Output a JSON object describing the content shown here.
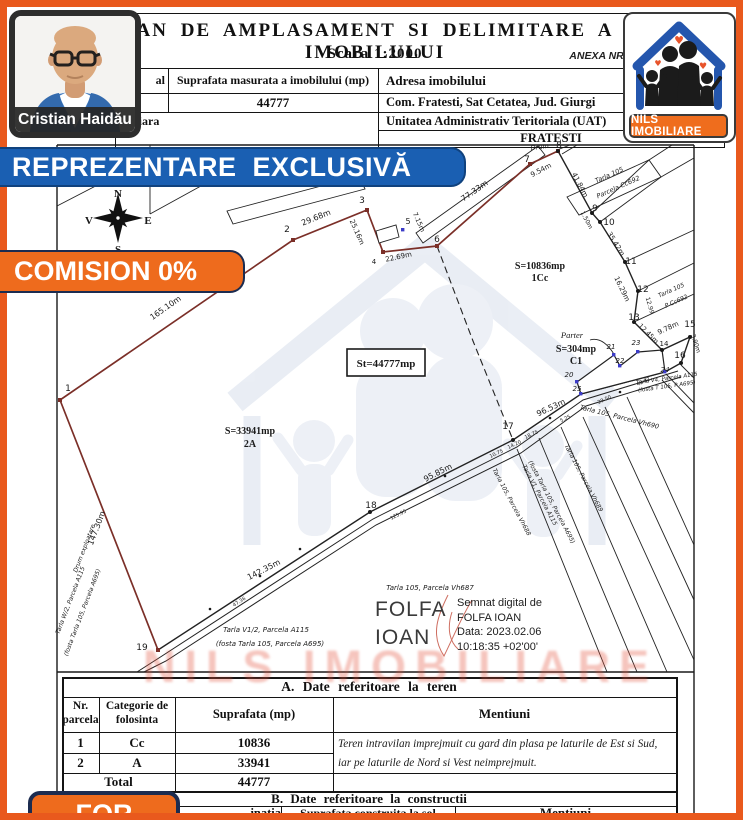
{
  "header": {
    "title_visible": "AN DE AMPLASAMENT SI DELIMITARE A IMOBILULUI",
    "scale": "Scara 1:2000",
    "annex": "ANEXA NR. 1.35",
    "col1_row1_fragment": "al",
    "surface_label": "Suprafata masurata a imobilului (mp)",
    "address_label": "Adresa imobilului",
    "surface_value": "44777",
    "address_value": "Com. Fratesti, Sat Cetatea, Jud. Giurgi",
    "col1_row3_fragment": "unciara",
    "uat_label": "Unitatea Administrativ Teritoriala (UAT)",
    "uat_value": "FRATESTI"
  },
  "agent": {
    "name": "Cristian Haidău"
  },
  "logo": {
    "label": "NILS IMOBILIARE"
  },
  "banners": {
    "exclusive": "REPREZENTARE EXCLUSIVĂ",
    "commission": "COMISION 0%",
    "corner": "FOR"
  },
  "watermark": {
    "text": "NILS IMOBILIARE"
  },
  "signature": {
    "name_line1": "FOLFA",
    "name_line2": "IOAN",
    "lines": [
      "Semnat digital de",
      "FOLFA IOAN",
      "Data: 2023.02.06",
      "10:18:35 +02'00'"
    ]
  },
  "table_a": {
    "section_title": "A. Date referitoare la teren",
    "h_nr_1": "Nr.",
    "h_nr_2": "parcela",
    "h_cat_1": "Categorie de",
    "h_cat_2": "folosinta",
    "h_sup": "Suprafata (mp)",
    "h_men": "Mentiuni",
    "rows": [
      {
        "nr": "1",
        "cat": "Cc",
        "area": "10836"
      },
      {
        "nr": "2",
        "cat": "A",
        "area": "33941"
      }
    ],
    "mentiuni_line1": "Teren intravilan imprejmuit cu gard din plasa pe laturile de Est si Sud,",
    "mentiuni_line2": "iar pe laturile de Nord si Vest neimprejmuit.",
    "total_label": "Total",
    "total_value": "44777"
  },
  "table_b": {
    "section_title": "B. Date referitoare la constructii",
    "destinatia_fragment": "inatia",
    "h_sup_1": "Suprafata construita la sol",
    "h_sup_2": "(mp)",
    "h_men": "Mentiuni"
  },
  "plan": {
    "labels": [
      {
        "t": "1",
        "x": 68,
        "y": 391,
        "s": 9
      },
      {
        "t": "2",
        "x": 287,
        "y": 232,
        "s": 9
      },
      {
        "t": "3",
        "x": 362,
        "y": 203,
        "s": 9
      },
      {
        "t": "4",
        "x": 374,
        "y": 264,
        "s": 7
      },
      {
        "t": "5",
        "x": 408,
        "y": 224,
        "s": 8
      },
      {
        "t": "6",
        "x": 437,
        "y": 242,
        "s": 9
      },
      {
        "t": "7",
        "x": 527,
        "y": 162,
        "s": 9
      },
      {
        "t": "8",
        "x": 559,
        "y": 148,
        "s": 9
      },
      {
        "t": "9",
        "x": 595,
        "y": 211,
        "s": 9
      },
      {
        "t": "10",
        "x": 609,
        "y": 225,
        "s": 9
      },
      {
        "t": "11",
        "x": 631,
        "y": 264,
        "s": 9
      },
      {
        "t": "12",
        "x": 643,
        "y": 292,
        "s": 9
      },
      {
        "t": "13",
        "x": 634,
        "y": 320,
        "s": 9
      },
      {
        "t": "14",
        "x": 664,
        "y": 346,
        "s": 7
      },
      {
        "t": "15",
        "x": 690,
        "y": 327,
        "s": 9
      },
      {
        "t": "16",
        "x": 680,
        "y": 358,
        "s": 9
      },
      {
        "t": "17",
        "x": 508,
        "y": 429,
        "s": 9
      },
      {
        "t": "18",
        "x": 371,
        "y": 508,
        "s": 9
      },
      {
        "t": "19",
        "x": 142,
        "y": 650,
        "s": 9
      },
      {
        "t": "20",
        "x": 569,
        "y": 377,
        "s": 7,
        "i": 1
      },
      {
        "t": "21",
        "x": 611,
        "y": 349,
        "s": 7,
        "i": 1
      },
      {
        "t": "22",
        "x": 620,
        "y": 363,
        "s": 7,
        "i": 1
      },
      {
        "t": "23",
        "x": 636,
        "y": 345,
        "s": 7,
        "i": 1
      },
      {
        "t": "24",
        "x": 665,
        "y": 372,
        "s": 7,
        "i": 1
      },
      {
        "t": "25",
        "x": 577,
        "y": 391,
        "s": 7,
        "i": 1
      },
      {
        "t": "165.10m",
        "x": 167,
        "y": 310,
        "r": -35,
        "s": 8
      },
      {
        "t": "29.68m",
        "x": 317,
        "y": 220,
        "r": -22,
        "s": 8
      },
      {
        "t": "25.16m",
        "x": 355,
        "y": 233,
        "r": 66,
        "s": 7
      },
      {
        "t": "22.69m",
        "x": 399,
        "y": 259,
        "r": -12,
        "s": 7
      },
      {
        "t": "7.15m",
        "x": 417,
        "y": 223,
        "r": 66,
        "s": 6.5
      },
      {
        "t": "77.33m",
        "x": 476,
        "y": 193,
        "r": -35,
        "s": 8
      },
      {
        "t": "9.54m",
        "x": 542,
        "y": 172,
        "r": -28,
        "s": 7
      },
      {
        "t": "Drum",
        "x": 540,
        "y": 149,
        "r": -8,
        "s": 6.5,
        "i": 1
      },
      {
        "t": "41.84m",
        "x": 578,
        "y": 186,
        "r": 62,
        "s": 7
      },
      {
        "t": "1.50m",
        "x": 585,
        "y": 221,
        "r": 62,
        "s": 6
      },
      {
        "t": "35.42m",
        "x": 614,
        "y": 245,
        "r": 58,
        "s": 7
      },
      {
        "t": "16.29m",
        "x": 620,
        "y": 290,
        "r": 64,
        "s": 7
      },
      {
        "t": "12.99",
        "x": 648,
        "y": 306,
        "r": 74,
        "s": 6
      },
      {
        "t": "12.45m",
        "x": 647,
        "y": 335,
        "r": 45,
        "s": 6.5
      },
      {
        "t": "9.78m",
        "x": 669,
        "y": 330,
        "r": -25,
        "s": 7
      },
      {
        "t": "3.90m",
        "x": 694,
        "y": 344,
        "r": 72,
        "s": 6
      },
      {
        "t": "96.53m",
        "x": 552,
        "y": 410,
        "r": -25,
        "s": 8
      },
      {
        "t": "95.85m",
        "x": 439,
        "y": 475,
        "r": -27,
        "s": 8
      },
      {
        "t": "142.35m",
        "x": 265,
        "y": 572,
        "r": -27,
        "s": 8
      },
      {
        "t": "147.30m",
        "x": 99,
        "y": 529,
        "r": -69,
        "s": 8
      },
      {
        "t": "Drum exploatare",
        "x": 86,
        "y": 549,
        "r": -69,
        "s": 6,
        "i": 1
      },
      {
        "t": "125.95",
        "x": 399,
        "y": 516,
        "r": -27,
        "s": 5
      },
      {
        "t": "47.36",
        "x": 240,
        "y": 603,
        "r": -33,
        "s": 5
      },
      {
        "t": "10.75",
        "x": 497,
        "y": 455,
        "r": -25,
        "s": 5
      },
      {
        "t": "14.20",
        "x": 515,
        "y": 446,
        "r": -25,
        "s": 5
      },
      {
        "t": "18.75",
        "x": 532,
        "y": 436,
        "r": -25,
        "s": 5
      },
      {
        "t": "5.25",
        "x": 566,
        "y": 420,
        "r": -25,
        "s": 5
      },
      {
        "t": "29.50",
        "x": 605,
        "y": 401,
        "r": -25,
        "s": 5
      },
      {
        "t": "49.82",
        "x": 644,
        "y": 383,
        "r": -25,
        "s": 5
      },
      {
        "t": "S=10836mp",
        "x": 540,
        "y": 269,
        "s": 10,
        "b": 1,
        "f": "serif"
      },
      {
        "t": "1Cc",
        "x": 540,
        "y": 281,
        "s": 10,
        "b": 1,
        "f": "serif"
      },
      {
        "t": "St=44777mp",
        "x": 386,
        "y": 367,
        "s": 11,
        "b": 1,
        "f": "serif"
      },
      {
        "t": "S=33941mp",
        "x": 250,
        "y": 434,
        "s": 10,
        "b": 1,
        "f": "serif"
      },
      {
        "t": "2A",
        "x": 250,
        "y": 447,
        "s": 10,
        "b": 1,
        "f": "serif"
      },
      {
        "t": "Parter",
        "x": 572,
        "y": 338,
        "s": 8.5,
        "i": 1,
        "f": "serif"
      },
      {
        "t": "S=304mp",
        "x": 576,
        "y": 352,
        "s": 10,
        "b": 1,
        "f": "serif"
      },
      {
        "t": "C1",
        "x": 576,
        "y": 364,
        "s": 10,
        "b": 1,
        "f": "serif"
      },
      {
        "t": "Tarla 105",
        "x": 610,
        "y": 177,
        "r": -24,
        "s": 6.5,
        "i": 1
      },
      {
        "t": "Parcela Cc692",
        "x": 619,
        "y": 189,
        "r": -24,
        "s": 6.5,
        "i": 1
      },
      {
        "t": "Tarla 105",
        "x": 672,
        "y": 292,
        "r": -24,
        "s": 6,
        "i": 1
      },
      {
        "t": "P Cc692",
        "x": 677,
        "y": 303,
        "r": -24,
        "s": 6,
        "i": 1
      },
      {
        "t": "Tarla V4, Parcela A115",
        "x": 667,
        "y": 380,
        "r": -8,
        "s": 5.5,
        "i": 1
      },
      {
        "t": "(fosta T 105, P A695)",
        "x": 667,
        "y": 388,
        "r": -8,
        "s": 5.5,
        "i": 1
      },
      {
        "t": "Tarla 105, Parcela Vh690",
        "x": 619,
        "y": 419,
        "r": 14,
        "s": 6.5,
        "i": 1
      },
      {
        "t": "Tarla 105, Parcela Vh688",
        "x": 510,
        "y": 503,
        "r": 62,
        "s": 6,
        "i": 1
      },
      {
        "t": "Tarla V1, Parcela A115",
        "x": 538,
        "y": 496,
        "r": 62,
        "s": 6,
        "i": 1
      },
      {
        "t": "(fosta Tarla 105, Parcela A695)",
        "x": 550,
        "y": 503,
        "r": 62,
        "s": 6,
        "i": 1
      },
      {
        "t": "Tarla 105, Parcela Vh689",
        "x": 582,
        "y": 479,
        "r": 62,
        "s": 6,
        "i": 1
      },
      {
        "t": "Tarla W/2, Parcela A115",
        "x": 72,
        "y": 601,
        "r": -69,
        "s": 6,
        "i": 1
      },
      {
        "t": "(fosta Tarla 105, Parcela A695)",
        "x": 84,
        "y": 613,
        "r": -69,
        "s": 6,
        "i": 1
      },
      {
        "t": "Tarla 105, Parcela Vh687",
        "x": 430,
        "y": 590,
        "s": 7,
        "i": 1
      },
      {
        "t": "Tarla V1/2, Parcela A115",
        "x": 266,
        "y": 632,
        "s": 7,
        "i": 1
      },
      {
        "t": "(fosta Tarla 105, Parcela A695)",
        "x": 270,
        "y": 646,
        "s": 7,
        "i": 1
      },
      {
        "t": "N",
        "x": 118,
        "y": 197,
        "s": 11,
        "b": 1,
        "f": "serif"
      },
      {
        "t": "S",
        "x": 118,
        "y": 253,
        "s": 11,
        "b": 1,
        "f": "serif"
      },
      {
        "t": "V",
        "x": 89,
        "y": 224,
        "s": 11,
        "b": 1,
        "f": "serif"
      },
      {
        "t": "E",
        "x": 148,
        "y": 224,
        "s": 11,
        "b": 1,
        "f": "serif"
      }
    ]
  }
}
